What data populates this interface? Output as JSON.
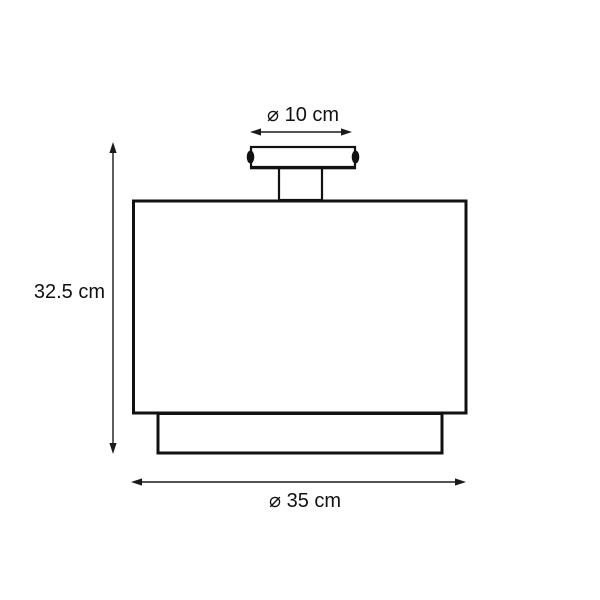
{
  "diagram": {
    "title": "lamp-dimension-drawing",
    "labels": {
      "top_diameter": "⌀ 10 cm",
      "height": "32.5 cm",
      "bottom_diameter": "⌀ 35 cm"
    },
    "dimensions": {
      "canopy_diameter_cm": 10,
      "total_height_cm": 32.5,
      "shade_diameter_cm": 35
    },
    "colors": {
      "background": "#ffffff",
      "outline": "#111111",
      "dimension_line": "#1a1a1a",
      "text": "#111111"
    }
  }
}
